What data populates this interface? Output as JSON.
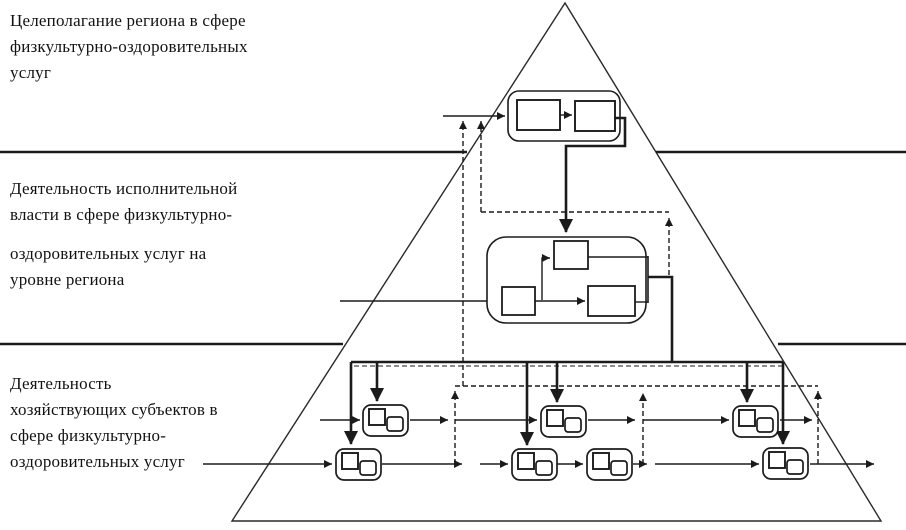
{
  "page": {
    "background": "#ffffff",
    "line_color": "#1b1b1b"
  },
  "labels": {
    "tier1": "Целеполагание региона в сфере\nфизкультурно-оздоровительных\nуслуг",
    "tier2_part1": "Деятельность исполнительной\nвласти в сфере физкультурно-",
    "tier2_part2": "оздоровительных услуг на\nуровне региона",
    "tier3": "Деятельность\nхозяйствующих субъектов в\nсфере физкультурно-\nоздоровительных услуг"
  },
  "icons": {
    "pyramid": "pyramid-outline",
    "solid_arrow": "solid-flow-arrow",
    "dashed_arrow": "dashed-feedback-arrow"
  }
}
